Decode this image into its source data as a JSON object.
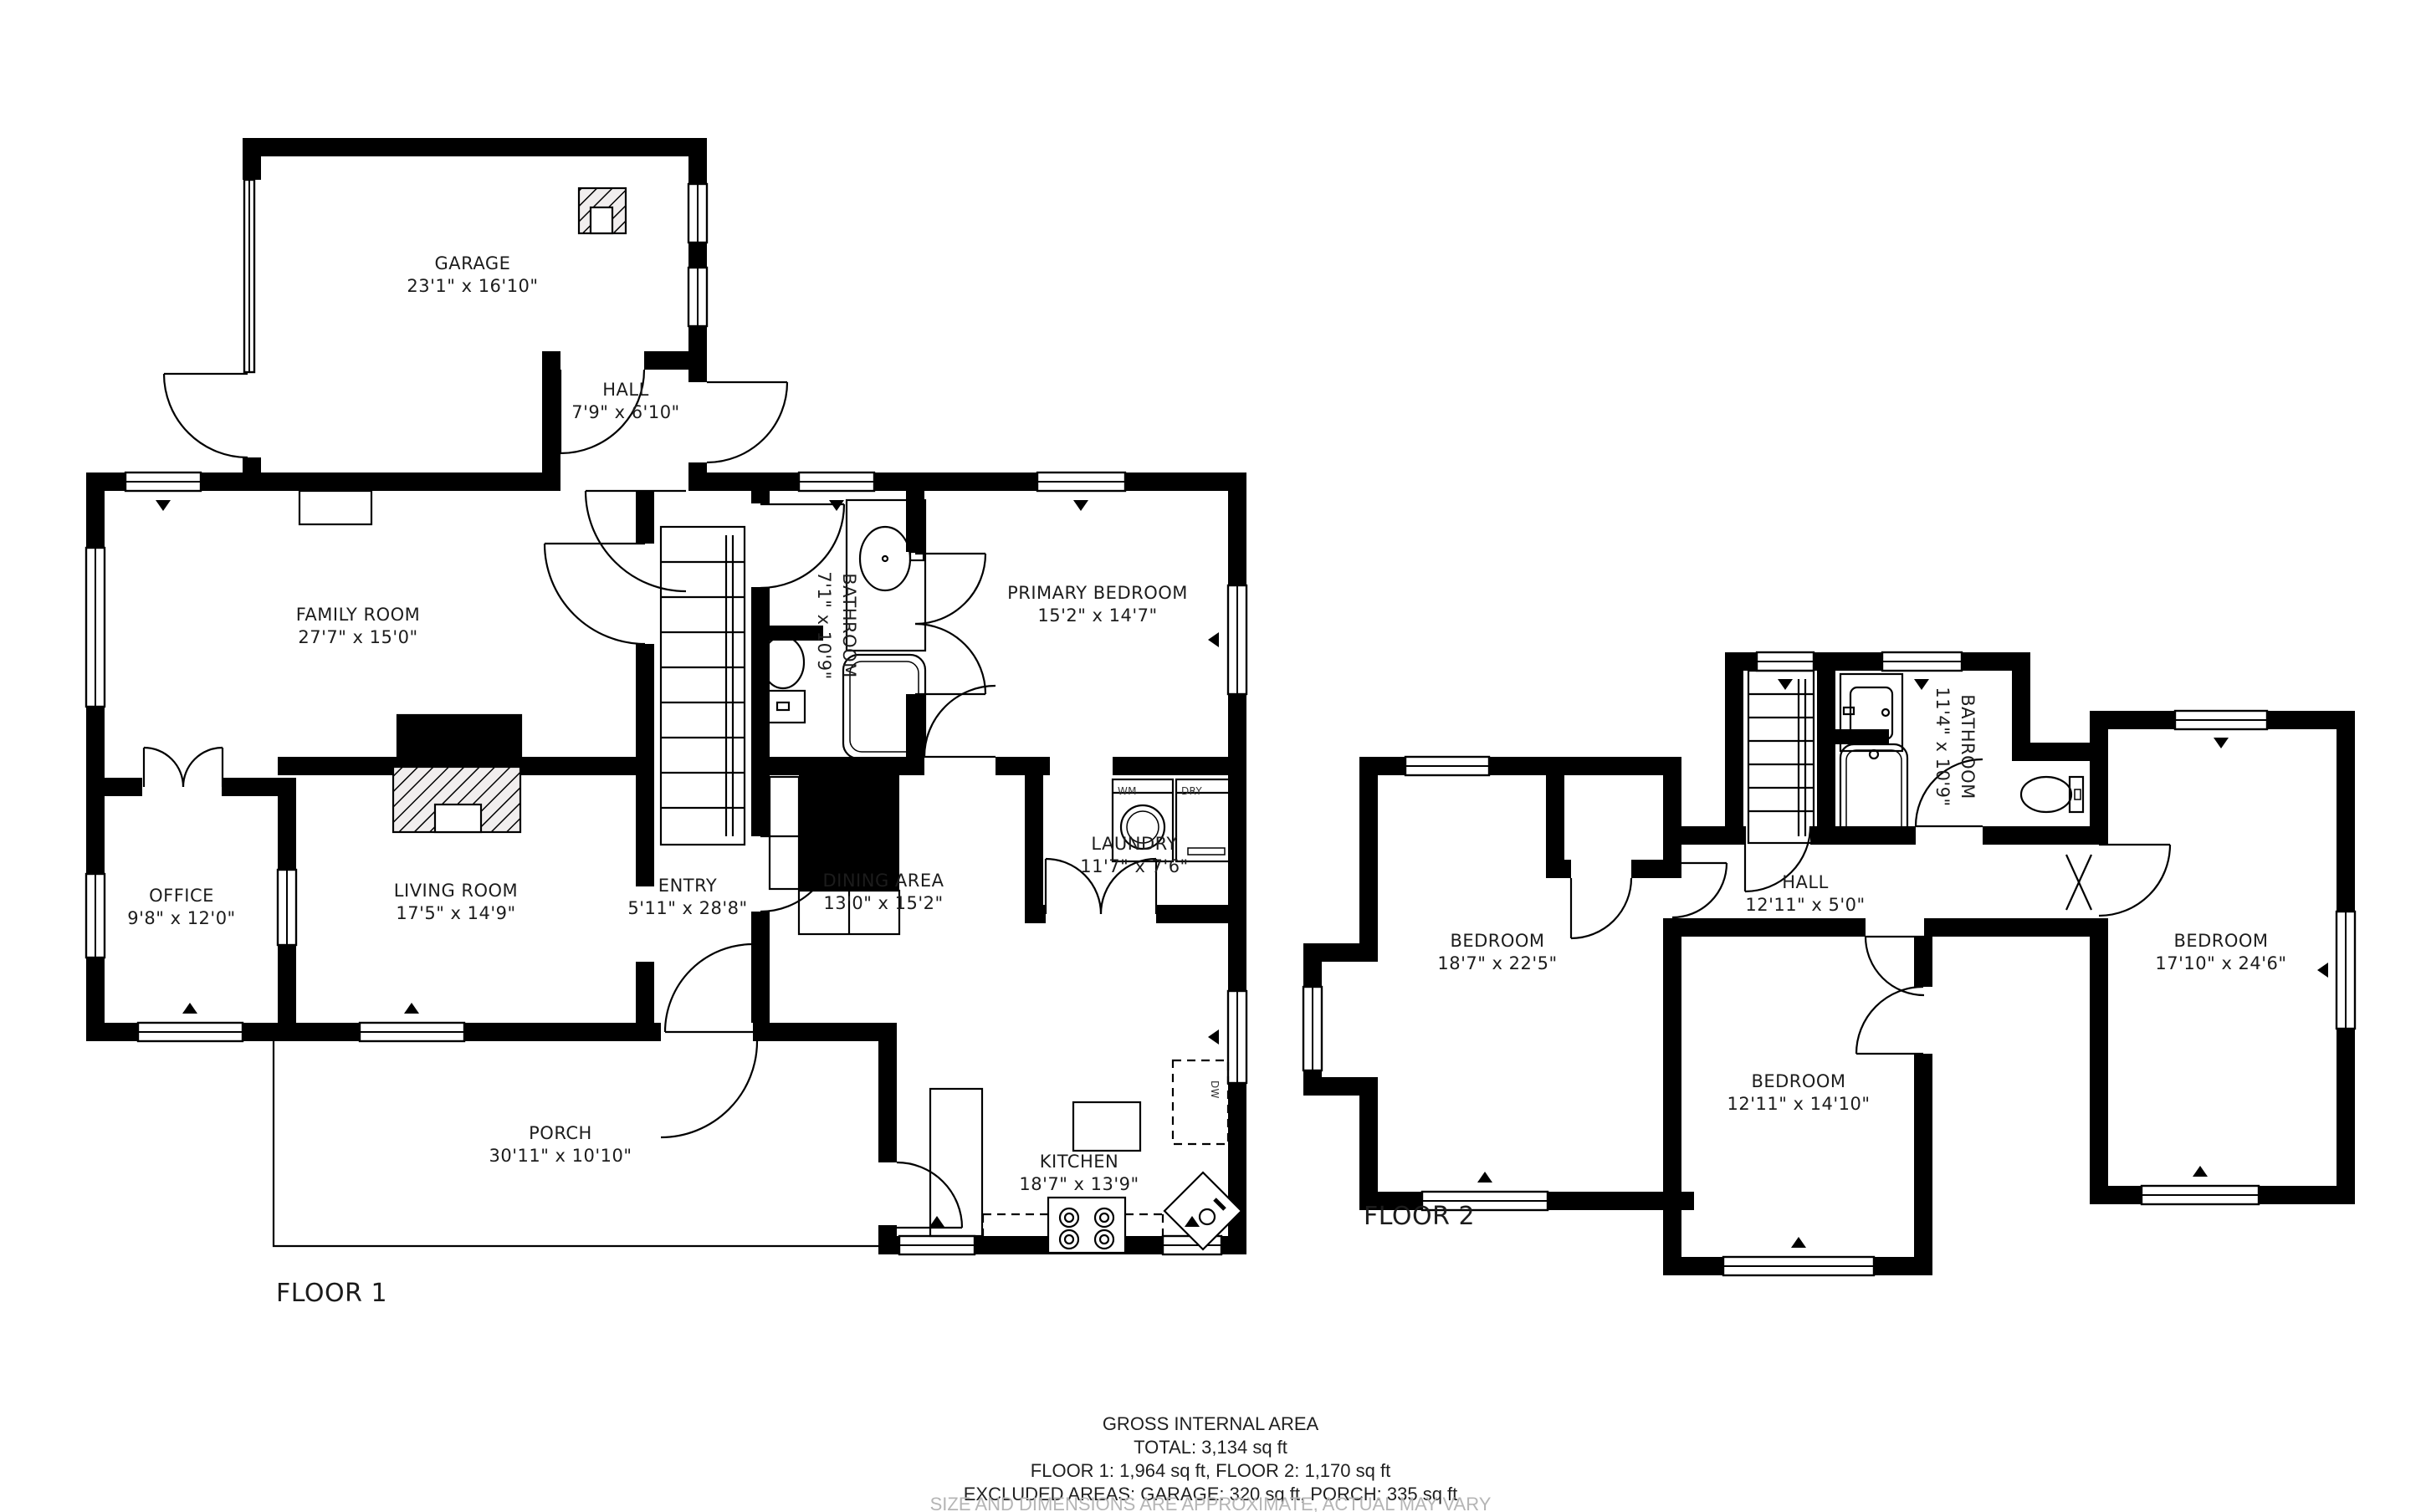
{
  "floor1": {
    "title": "FLOOR 1",
    "rooms": {
      "garage": {
        "name": "GARAGE",
        "dims": "23'1\" x 16'10\""
      },
      "hall": {
        "name": "HALL",
        "dims": "7'9\" x 6'10\""
      },
      "family_room": {
        "name": "FAMILY ROOM",
        "dims": "27'7\" x 15'0\""
      },
      "bathroom": {
        "name": "BATHROOM",
        "dims": "7'1\" x 10'9\""
      },
      "primary_bedroom": {
        "name": "PRIMARY BEDROOM",
        "dims": "15'2\" x 14'7\""
      },
      "office": {
        "name": "OFFICE",
        "dims": "9'8\" x 12'0\""
      },
      "living_room": {
        "name": "LIVING ROOM",
        "dims": "17'5\" x 14'9\""
      },
      "entry": {
        "name": "ENTRY",
        "dims": "5'11\" x 28'8\""
      },
      "dining_area": {
        "name": "DINING AREA",
        "dims": "13'0\" x 15'2\""
      },
      "laundry": {
        "name": "LAUNDRY",
        "dims": "11'7\" x 7'6\""
      },
      "porch": {
        "name": "PORCH",
        "dims": "30'11\" x 10'10\""
      },
      "kitchen": {
        "name": "KITCHEN",
        "dims": "18'7\" x 13'9\""
      }
    },
    "appliances": {
      "washer": "WM",
      "dryer": "DRY",
      "dishwasher": "DW"
    }
  },
  "floor2": {
    "title": "FLOOR 2",
    "rooms": {
      "bedroom_left": {
        "name": "BEDROOM",
        "dims": "18'7\" x 22'5\""
      },
      "hall": {
        "name": "HALL",
        "dims": "12'11\" x 5'0\""
      },
      "bathroom": {
        "name": "BATHROOM",
        "dims": "11'4\" x 10'9\""
      },
      "bedroom_middle": {
        "name": "BEDROOM",
        "dims": "12'11\" x 14'10\""
      },
      "bedroom_right": {
        "name": "BEDROOM",
        "dims": "17'10\" x 24'6\""
      }
    }
  },
  "summary": {
    "heading": "GROSS INTERNAL AREA",
    "total": "TOTAL: 3,134 sq ft",
    "floors": "FLOOR 1: 1,964 sq ft, FLOOR 2: 1,170 sq ft",
    "excluded": "EXCLUDED AREAS: GARAGE: 320 sq ft, PORCH: 335 sq ft",
    "disclaimer": "SIZE AND DIMENSIONS ARE APPROXIMATE, ACTUAL MAY VARY"
  },
  "colors": {
    "wall": "#000000",
    "background": "#ffffff",
    "text": "#1c1c1c",
    "muted": "#b5b5b5"
  }
}
